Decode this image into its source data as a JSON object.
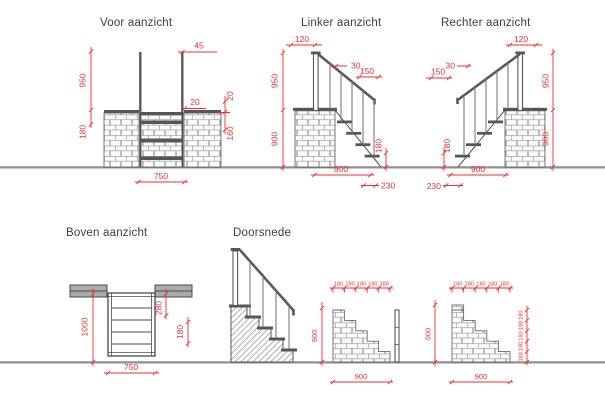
{
  "titles": {
    "voor": "Voor aanzicht",
    "linker": "Linker aanzicht",
    "rechter": "Rechter aanzicht",
    "boven": "Boven aanzicht",
    "doorsnede": "Doorsnede"
  },
  "dims": {
    "voor": {
      "h950": "950",
      "h180": "180",
      "w45": "45",
      "w20": "20",
      "h20": "20",
      "h160": "160",
      "w750": "750"
    },
    "linker": {
      "w120": "120",
      "h950": "950",
      "h900": "900",
      "w30": "30",
      "w150": "150",
      "h180": "180",
      "w900": "900",
      "w230": "230"
    },
    "rechter": {
      "w120": "120",
      "h950": "950",
      "h900": "900",
      "w30": "30",
      "w150": "150",
      "h180": "180",
      "w900": "900",
      "w230": "230"
    },
    "boven": {
      "h1000": "1000",
      "h280": "280",
      "h180": "180",
      "w750": "750"
    },
    "detail_left": {
      "treads": [
        "180",
        "180",
        "180",
        "180",
        "180"
      ],
      "h900": "900",
      "w900": "900"
    },
    "detail_right": {
      "treads": [
        "180",
        "180",
        "180",
        "180",
        "180"
      ],
      "risers": [
        "180",
        "180",
        "180",
        "180",
        "180"
      ],
      "h900": "900",
      "w900": "900"
    }
  },
  "colors": {
    "dimension_red": "#ee2f2f",
    "outline_dark": "#4d4d4d",
    "steel_gray": "#565656",
    "brick_mortar": "#a3a3a3",
    "ground_gray": "#8f8f8f",
    "title_text": "#3d3d3d",
    "plan_wall_fill": "#ababab"
  }
}
